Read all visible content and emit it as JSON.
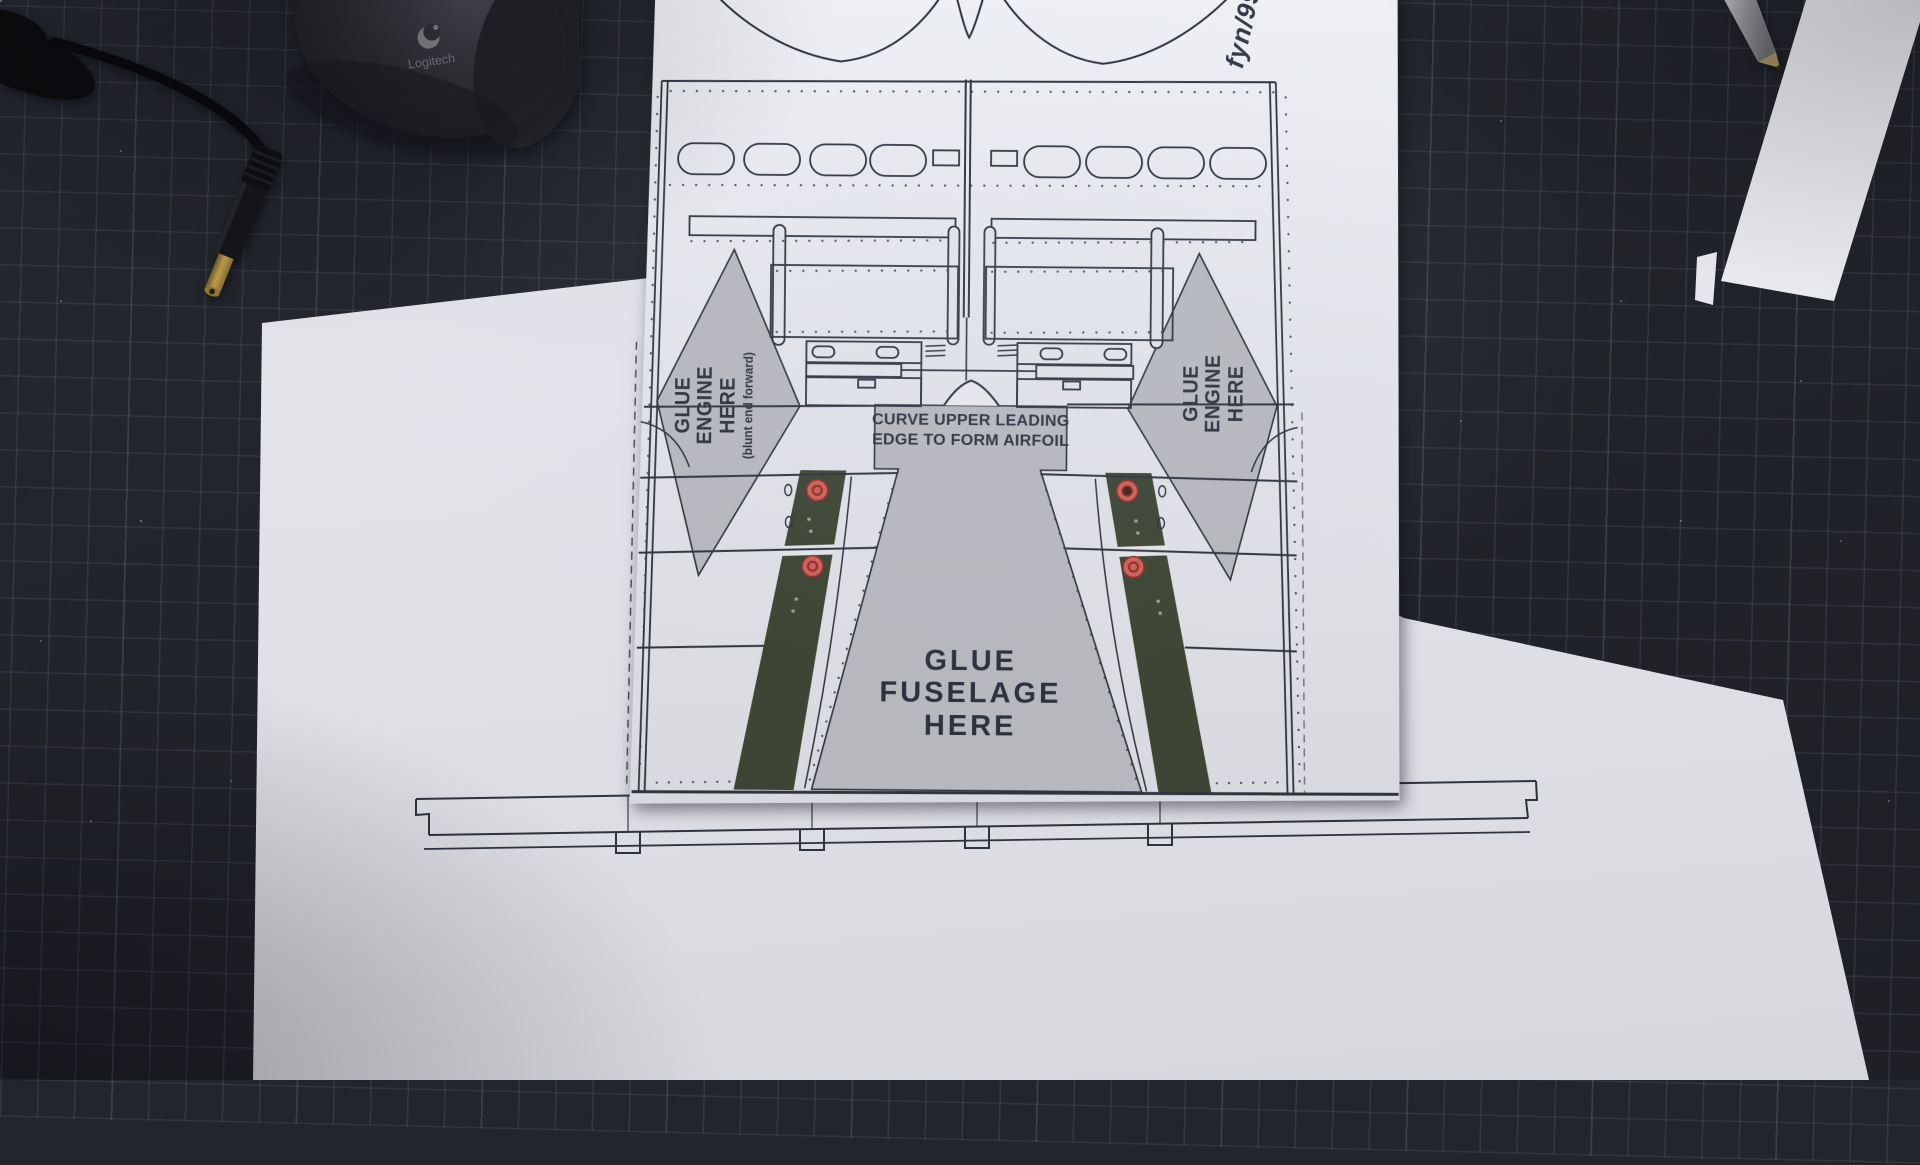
{
  "colors": {
    "mat": "#23252c",
    "mat_grid": "#848EAA",
    "paper": "#e4e5ea",
    "print": "#2e3340",
    "panel_gray": "#b7b8be",
    "strip_green": "#3d4634",
    "marker_red": "#cf6058",
    "mouse_body": "#33343a",
    "brass": "#c3a14e"
  },
  "template_sheet": {
    "code": "fyn/99",
    "engine_label_left": {
      "line1": "GLUE",
      "line2": "ENGINE",
      "line3": "HERE",
      "note": "(blunt end forward)"
    },
    "engine_label_right": {
      "line1": "GLUE",
      "line2": "ENGINE",
      "line3": "HERE"
    },
    "airfoil_note": {
      "line1": "CURVE UPPER LEADING",
      "line2": "EDGE TO FORM AIRFOIL"
    },
    "fuselage_label": {
      "line1": "GLUE",
      "line2": "FUSELAGE",
      "line3": "HERE"
    }
  },
  "objects": {
    "mouse_brand": "Logitech"
  }
}
